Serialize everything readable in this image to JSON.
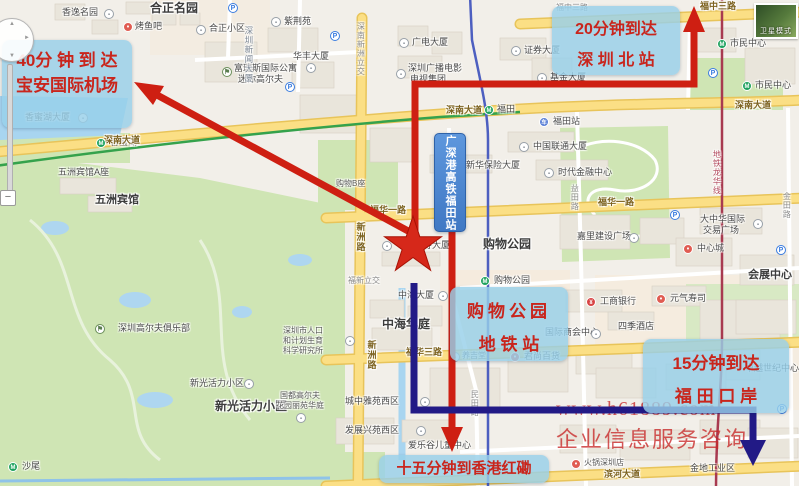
{
  "callouts": {
    "airport": {
      "line1": "40分 钟 到 达",
      "line2": "宝安国际机场"
    },
    "north_station": {
      "line1": "20分钟到达",
      "line2": "深 圳 北 站"
    },
    "futian_hsr": {
      "text": "广深港高铁福田站"
    },
    "shopping_park": {
      "line1": "购物公园",
      "line2": "地 铁 站"
    },
    "futian_port": {
      "line1": "15分钟到达",
      "line2": "福 田 口 岸"
    },
    "hung_hom": {
      "line1": "十五分钟到香港红磡"
    }
  },
  "watermark": {
    "line1": "www.h61889.com",
    "line2": "企业信息服务咨询"
  },
  "controls": {
    "satellite_label": "卫星模式",
    "zoom_out": "−"
  },
  "colors": {
    "route_red": "#ce1f12",
    "route_navy": "#221a86",
    "callout_bg": "rgba(151,208,233,0.82)",
    "callout_text": "#c9251c",
    "hsr_box_bg": "#4f8ad2",
    "park_green": "#cfe5b4",
    "water_blue": "#a8d5f0",
    "major_road_yellow": "#fbdf85"
  },
  "map": {
    "labels": [
      {
        "t": "合正名园",
        "x": 150,
        "y": 2,
        "c": "big"
      },
      {
        "t": "香逸名园",
        "x": 62,
        "y": 8,
        "c": "poi"
      },
      {
        "t": "烤鱼吧",
        "x": 135,
        "y": 22,
        "c": "poi"
      },
      {
        "t": "合正小区",
        "x": 209,
        "y": 24,
        "c": "poi"
      },
      {
        "t": "紫荆苑",
        "x": 284,
        "y": 17,
        "c": "poi"
      },
      {
        "t": "华丰大厦",
        "x": 293,
        "y": 52,
        "c": "poi"
      },
      {
        "t": "富瑞斯国际公寓",
        "x": 234,
        "y": 64,
        "c": "poi"
      },
      {
        "t": "迷你高尔夫",
        "x": 238,
        "y": 75,
        "c": "poi"
      },
      {
        "t": "广电大厦",
        "x": 412,
        "y": 38,
        "c": "poi"
      },
      {
        "t": "深圳广播电影",
        "x": 408,
        "y": 64,
        "c": "poi"
      },
      {
        "t": "电视集团",
        "x": 410,
        "y": 75,
        "c": "poi"
      },
      {
        "t": "证券大厦",
        "x": 524,
        "y": 46,
        "c": "poi"
      },
      {
        "t": "基金大厦",
        "x": 550,
        "y": 73,
        "c": "poi"
      },
      {
        "t": "市民中心",
        "x": 730,
        "y": 39,
        "c": "poi"
      },
      {
        "t": "市民中心",
        "x": 755,
        "y": 81,
        "c": "poi"
      },
      {
        "t": "香蜜湖大厦",
        "x": 25,
        "y": 113,
        "c": "poi"
      },
      {
        "t": "香蜜湖",
        "x": 110,
        "y": 138,
        "c": "poi"
      },
      {
        "t": "福田",
        "x": 497,
        "y": 105,
        "c": "poi"
      },
      {
        "t": "五洲宾馆A座",
        "x": 58,
        "y": 168,
        "c": "poi"
      },
      {
        "t": "五洲宾馆",
        "x": 95,
        "y": 195,
        "c": "big2"
      },
      {
        "t": "福田站",
        "x": 553,
        "y": 117,
        "c": "poi"
      },
      {
        "t": "中国联通大厦",
        "x": 533,
        "y": 142,
        "c": "poi"
      },
      {
        "t": "新华保险大厦",
        "x": 466,
        "y": 161,
        "c": "poi"
      },
      {
        "t": "时代金融中心",
        "x": 558,
        "y": 168,
        "c": "poi"
      },
      {
        "t": "大中华国际",
        "x": 700,
        "y": 215,
        "c": "poi"
      },
      {
        "t": "交易广场",
        "x": 703,
        "y": 226,
        "c": "poi"
      },
      {
        "t": "中心城",
        "x": 697,
        "y": 244,
        "c": "poi"
      },
      {
        "t": "会展中心",
        "x": 748,
        "y": 270,
        "c": "big2"
      },
      {
        "t": "嘉里建设广场",
        "x": 577,
        "y": 232,
        "c": "poi"
      },
      {
        "t": "购物公园",
        "x": 483,
        "y": 238,
        "c": "big"
      },
      {
        "t": "购物公园",
        "x": 494,
        "y": 276,
        "c": "poi"
      },
      {
        "t": "中国人寿大厦",
        "x": 396,
        "y": 241,
        "c": "poi"
      },
      {
        "t": "中海大厦",
        "x": 398,
        "y": 291,
        "c": "poi"
      },
      {
        "t": "购物B座",
        "x": 336,
        "y": 180,
        "c": "poism"
      },
      {
        "t": "福新立交",
        "x": 348,
        "y": 277,
        "c": "roadg"
      },
      {
        "t": "中海华庭",
        "x": 382,
        "y": 318,
        "c": "big"
      },
      {
        "t": "养吉堂",
        "x": 462,
        "y": 352,
        "c": "poism"
      },
      {
        "t": "君尚百货",
        "x": 524,
        "y": 352,
        "c": "poi"
      },
      {
        "t": "工商银行",
        "x": 600,
        "y": 297,
        "c": "poi"
      },
      {
        "t": "元气寿司",
        "x": 670,
        "y": 294,
        "c": "poi"
      },
      {
        "t": "四季酒店",
        "x": 618,
        "y": 322,
        "c": "poi"
      },
      {
        "t": "国际商会中心",
        "x": 545,
        "y": 328,
        "c": "poi"
      },
      {
        "t": "卓越世纪中心",
        "x": 745,
        "y": 364,
        "c": "poi"
      },
      {
        "t": "深圳高尔夫俱乐部",
        "x": 118,
        "y": 324,
        "c": "poi"
      },
      {
        "t": "深圳市人口",
        "x": 283,
        "y": 327,
        "c": "poism"
      },
      {
        "t": "和计划生育",
        "x": 283,
        "y": 337,
        "c": "poism"
      },
      {
        "t": "科学研究所",
        "x": 283,
        "y": 347,
        "c": "poism"
      },
      {
        "t": "新光活力小区",
        "x": 190,
        "y": 379,
        "c": "poi"
      },
      {
        "t": "新光活力小区",
        "x": 215,
        "y": 400,
        "c": "big"
      },
      {
        "t": "国都高尔夫",
        "x": 280,
        "y": 392,
        "c": "poism"
      },
      {
        "t": "花园丽苑华庭",
        "x": 276,
        "y": 402,
        "c": "poism"
      },
      {
        "t": "城中雅苑西区",
        "x": 345,
        "y": 397,
        "c": "poi"
      },
      {
        "t": "发展兴苑西区",
        "x": 345,
        "y": 426,
        "c": "poi"
      },
      {
        "t": "爱乐谷儿童中心",
        "x": 408,
        "y": 441,
        "c": "poi"
      },
      {
        "t": "火锅深圳店",
        "x": 584,
        "y": 459,
        "c": "poism"
      },
      {
        "t": "金地工业区",
        "x": 690,
        "y": 464,
        "c": "poi"
      },
      {
        "t": "沙尾",
        "x": 22,
        "y": 462,
        "c": "poi"
      },
      {
        "t": "福中三路",
        "x": 556,
        "y": 4,
        "c": "roadg"
      },
      {
        "t": "福中三路",
        "x": 700,
        "y": 2,
        "c": "road"
      },
      {
        "t": "深南新洲立交",
        "x": 356,
        "y": 22,
        "c": "roadvg"
      },
      {
        "t": "深圳新闻大厦",
        "x": 244,
        "y": 26,
        "c": "bldv"
      },
      {
        "t": "深南大道",
        "x": 104,
        "y": 136,
        "c": "road"
      },
      {
        "t": "深南大道",
        "x": 446,
        "y": 106,
        "c": "road"
      },
      {
        "t": "深南大道",
        "x": 735,
        "y": 101,
        "c": "road"
      },
      {
        "t": "福华一路",
        "x": 370,
        "y": 206,
        "c": "road"
      },
      {
        "t": "福华一路",
        "x": 598,
        "y": 198,
        "c": "road"
      },
      {
        "t": "福华三路",
        "x": 406,
        "y": 348,
        "c": "road"
      },
      {
        "t": "滨河大道",
        "x": 604,
        "y": 470,
        "c": "road"
      },
      {
        "t": "新洲路",
        "x": 355,
        "y": 222,
        "c": "roadv"
      },
      {
        "t": "新洲路",
        "x": 366,
        "y": 340,
        "c": "roadv"
      },
      {
        "t": "民田路",
        "x": 440,
        "y": 190,
        "c": "roadvg"
      },
      {
        "t": "民田路",
        "x": 470,
        "y": 390,
        "c": "roadvg"
      },
      {
        "t": "益田路",
        "x": 570,
        "y": 184,
        "c": "roadvg"
      },
      {
        "t": "金田路",
        "x": 782,
        "y": 192,
        "c": "roadvg"
      },
      {
        "t": "地铁龙华线",
        "x": 712,
        "y": 150,
        "c": "metrolinev"
      }
    ],
    "icons": [
      {
        "k": "bld",
        "x": 104,
        "y": 9
      },
      {
        "k": "red",
        "x": 123,
        "y": 22
      },
      {
        "k": "bld",
        "x": 196,
        "y": 25
      },
      {
        "k": "bld",
        "x": 271,
        "y": 17
      },
      {
        "k": "bld",
        "x": 306,
        "y": 63
      },
      {
        "k": "golf",
        "x": 222,
        "y": 67
      },
      {
        "k": "bld",
        "x": 399,
        "y": 38
      },
      {
        "k": "bld",
        "x": 396,
        "y": 69
      },
      {
        "k": "bld",
        "x": 511,
        "y": 46
      },
      {
        "k": "bld",
        "x": 537,
        "y": 73
      },
      {
        "k": "bld",
        "x": 78,
        "y": 113
      },
      {
        "k": "metro",
        "x": 96,
        "y": 138
      },
      {
        "k": "metro",
        "x": 484,
        "y": 105
      },
      {
        "k": "metro",
        "x": 480,
        "y": 276
      },
      {
        "k": "metro",
        "x": 717,
        "y": 39
      },
      {
        "k": "metro",
        "x": 742,
        "y": 81
      },
      {
        "k": "metro",
        "x": 8,
        "y": 462
      },
      {
        "k": "rail",
        "x": 539,
        "y": 117
      },
      {
        "k": "bld",
        "x": 519,
        "y": 142
      },
      {
        "k": "bld",
        "x": 452,
        "y": 161
      },
      {
        "k": "bld",
        "x": 544,
        "y": 168
      },
      {
        "k": "bld",
        "x": 753,
        "y": 219
      },
      {
        "k": "red",
        "x": 683,
        "y": 244
      },
      {
        "k": "bld",
        "x": 629,
        "y": 233
      },
      {
        "k": "bld",
        "x": 382,
        "y": 241
      },
      {
        "k": "bld",
        "x": 438,
        "y": 291
      },
      {
        "k": "bld",
        "x": 450,
        "y": 352
      },
      {
        "k": "red",
        "x": 510,
        "y": 352
      },
      {
        "k": "bank",
        "x": 586,
        "y": 297
      },
      {
        "k": "red",
        "x": 656,
        "y": 294
      },
      {
        "k": "bld",
        "x": 591,
        "y": 329
      },
      {
        "k": "golf",
        "x": 95,
        "y": 324
      },
      {
        "k": "bld",
        "x": 345,
        "y": 336
      },
      {
        "k": "bld",
        "x": 244,
        "y": 379
      },
      {
        "k": "bld",
        "x": 296,
        "y": 413
      },
      {
        "k": "bld",
        "x": 420,
        "y": 397
      },
      {
        "k": "bld",
        "x": 416,
        "y": 426
      },
      {
        "k": "red",
        "x": 571,
        "y": 459
      },
      {
        "k": "parking",
        "x": 228,
        "y": 3
      },
      {
        "k": "parking",
        "x": 330,
        "y": 31
      },
      {
        "k": "parking",
        "x": 285,
        "y": 82
      },
      {
        "k": "parking",
        "x": 708,
        "y": 68
      },
      {
        "k": "parking",
        "x": 670,
        "y": 210
      },
      {
        "k": "parking",
        "x": 776,
        "y": 245
      },
      {
        "k": "parking",
        "x": 777,
        "y": 404
      }
    ]
  }
}
